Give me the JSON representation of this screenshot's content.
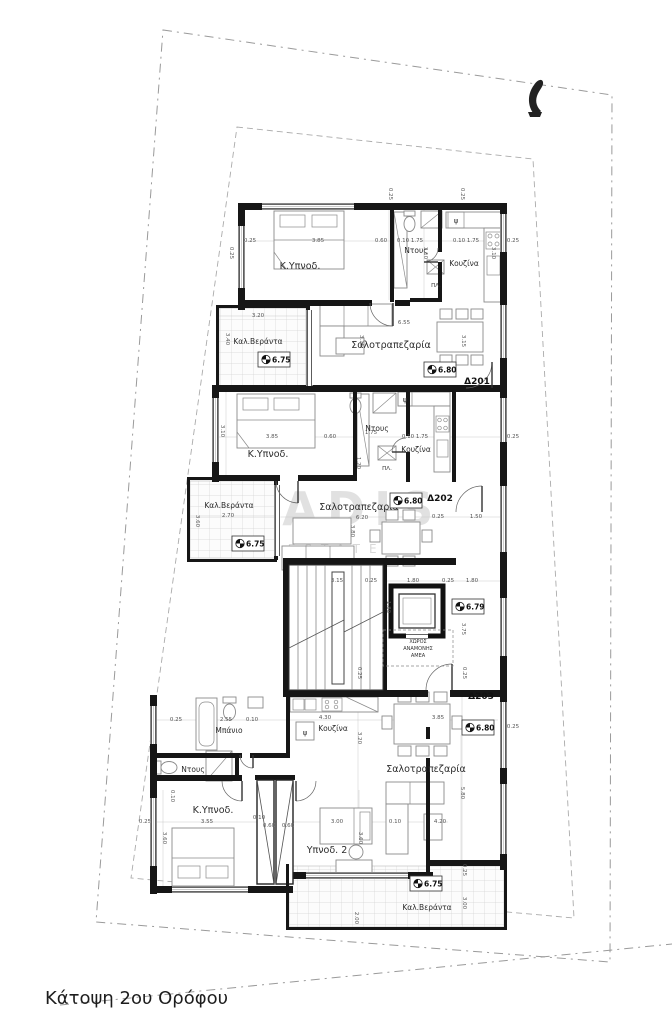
{
  "title": "Κάτοψη 2ου Ορόφου",
  "watermark": {
    "brand": "KADIS",
    "sub": "ESTATES"
  },
  "apartments": [
    {
      "id": "Δ201"
    },
    {
      "id": "Δ202"
    },
    {
      "id": "Δ203"
    }
  ],
  "markers": [
    {
      "value": "6.75"
    },
    {
      "value": "6.80"
    },
    {
      "value": "6.75"
    },
    {
      "value": "6.80"
    },
    {
      "value": "6.79"
    },
    {
      "value": "6.80"
    },
    {
      "value": "6.75"
    }
  ],
  "rooms": [
    {
      "label": "Κ.Υπνοδ."
    },
    {
      "label": "Ντους"
    },
    {
      "label": "Κουζίνα"
    },
    {
      "label": "Σαλοτραπεζαρία"
    },
    {
      "label": "Καλ.Βεράντα"
    },
    {
      "label": "Κ.Υπνοδ."
    },
    {
      "label": "Ντους"
    },
    {
      "label": "Κουζίνα"
    },
    {
      "label": "Σαλοτραπεζαρία"
    },
    {
      "label": "Καλ.Βεράντα"
    },
    {
      "label": "Μπάνιο"
    },
    {
      "label": "Κουζίνα"
    },
    {
      "label": "Σαλοτραπεζαρία"
    },
    {
      "label": "Ντους"
    },
    {
      "label": "Κ.Υπνοδ."
    },
    {
      "label": "Υπνοδ. 2"
    },
    {
      "label": "Καλ.Βεράντα"
    }
  ],
  "amea": {
    "line1": "ΧΩΡΟΣ",
    "line2": "ΑΝΑΜΟΝΗΣ",
    "line3": "ΑΜΕΑ"
  },
  "symbols": {
    "fridge": "ψ",
    "washer": "ΠΛ."
  },
  "dims": [
    {
      "x": 250,
      "y": 242,
      "t": "0.25"
    },
    {
      "x": 318,
      "y": 242,
      "t": "3.85"
    },
    {
      "x": 381,
      "y": 242,
      "t": "0.60"
    },
    {
      "x": 410,
      "y": 242,
      "t": "0.10 1.75"
    },
    {
      "x": 466,
      "y": 242,
      "t": "0.10 1.75"
    },
    {
      "x": 389,
      "y": 194,
      "t": "0.25",
      "r": 90
    },
    {
      "x": 461,
      "y": 194,
      "t": "0.25",
      "r": 90
    },
    {
      "x": 424,
      "y": 253,
      "t": "3.10",
      "r": 90
    },
    {
      "x": 492,
      "y": 253,
      "t": "3.10",
      "r": 90
    },
    {
      "x": 230,
      "y": 253,
      "t": "0.25",
      "r": 90
    },
    {
      "x": 513,
      "y": 242,
      "t": "0.25"
    },
    {
      "x": 404,
      "y": 324,
      "t": "6.55"
    },
    {
      "x": 360,
      "y": 341,
      "t": "3.15",
      "r": 90
    },
    {
      "x": 462,
      "y": 341,
      "t": "3.15",
      "r": 90
    },
    {
      "x": 258,
      "y": 317,
      "t": "3.20"
    },
    {
      "x": 226,
      "y": 339,
      "t": "3.40",
      "r": 90
    },
    {
      "x": 221,
      "y": 431,
      "t": "3.10",
      "r": 90
    },
    {
      "x": 272,
      "y": 438,
      "t": "3.85"
    },
    {
      "x": 330,
      "y": 438,
      "t": "0.60"
    },
    {
      "x": 371,
      "y": 434,
      "t": "1.75"
    },
    {
      "x": 415,
      "y": 438,
      "t": "0.10 1.75"
    },
    {
      "x": 513,
      "y": 438,
      "t": "0.25"
    },
    {
      "x": 357,
      "y": 463,
      "t": "1.20",
      "r": 90
    },
    {
      "x": 362,
      "y": 519,
      "t": "6.20"
    },
    {
      "x": 351,
      "y": 531,
      "t": "3.80",
      "r": 90
    },
    {
      "x": 438,
      "y": 518,
      "t": "0.25"
    },
    {
      "x": 476,
      "y": 518,
      "t": "1.50"
    },
    {
      "x": 228,
      "y": 517,
      "t": "2.70"
    },
    {
      "x": 196,
      "y": 521,
      "t": "3.60",
      "r": 90
    },
    {
      "x": 337,
      "y": 582,
      "t": "3.15"
    },
    {
      "x": 371,
      "y": 582,
      "t": "0.25"
    },
    {
      "x": 413,
      "y": 582,
      "t": "1.80"
    },
    {
      "x": 448,
      "y": 582,
      "t": "0.25"
    },
    {
      "x": 472,
      "y": 582,
      "t": "1.80"
    },
    {
      "x": 387,
      "y": 607,
      "t": "1.80",
      "r": 90
    },
    {
      "x": 462,
      "y": 629,
      "t": "3.75",
      "r": 90
    },
    {
      "x": 358,
      "y": 673,
      "t": "0.25",
      "r": 90
    },
    {
      "x": 463,
      "y": 673,
      "t": "0.25",
      "r": 90
    },
    {
      "x": 176,
      "y": 721,
      "t": "0.25"
    },
    {
      "x": 226,
      "y": 721,
      "t": "2.55"
    },
    {
      "x": 252,
      "y": 721,
      "t": "0.10"
    },
    {
      "x": 325,
      "y": 719,
      "t": "4.30"
    },
    {
      "x": 358,
      "y": 738,
      "t": "3.20",
      "r": 90
    },
    {
      "x": 438,
      "y": 719,
      "t": "3.85"
    },
    {
      "x": 461,
      "y": 793,
      "t": "5.80",
      "r": 90
    },
    {
      "x": 207,
      "y": 823,
      "t": "3.55"
    },
    {
      "x": 171,
      "y": 796,
      "t": "0.10",
      "r": 90
    },
    {
      "x": 163,
      "y": 838,
      "t": "3.60",
      "r": 90
    },
    {
      "x": 145,
      "y": 823,
      "t": "0.25"
    },
    {
      "x": 259,
      "y": 819,
      "t": "0.10"
    },
    {
      "x": 269,
      "y": 827,
      "t": "0.60"
    },
    {
      "x": 288,
      "y": 827,
      "t": "0.60"
    },
    {
      "x": 337,
      "y": 823,
      "t": "3.00"
    },
    {
      "x": 359,
      "y": 838,
      "t": "3.60",
      "r": 90
    },
    {
      "x": 395,
      "y": 823,
      "t": "0.10"
    },
    {
      "x": 440,
      "y": 823,
      "t": "4.20"
    },
    {
      "x": 513,
      "y": 728,
      "t": "0.25"
    },
    {
      "x": 355,
      "y": 918,
      "t": "2.00",
      "r": 90
    },
    {
      "x": 463,
      "y": 903,
      "t": "3.00",
      "r": 90
    },
    {
      "x": 463,
      "y": 870,
      "t": "0.25",
      "r": 90
    }
  ]
}
